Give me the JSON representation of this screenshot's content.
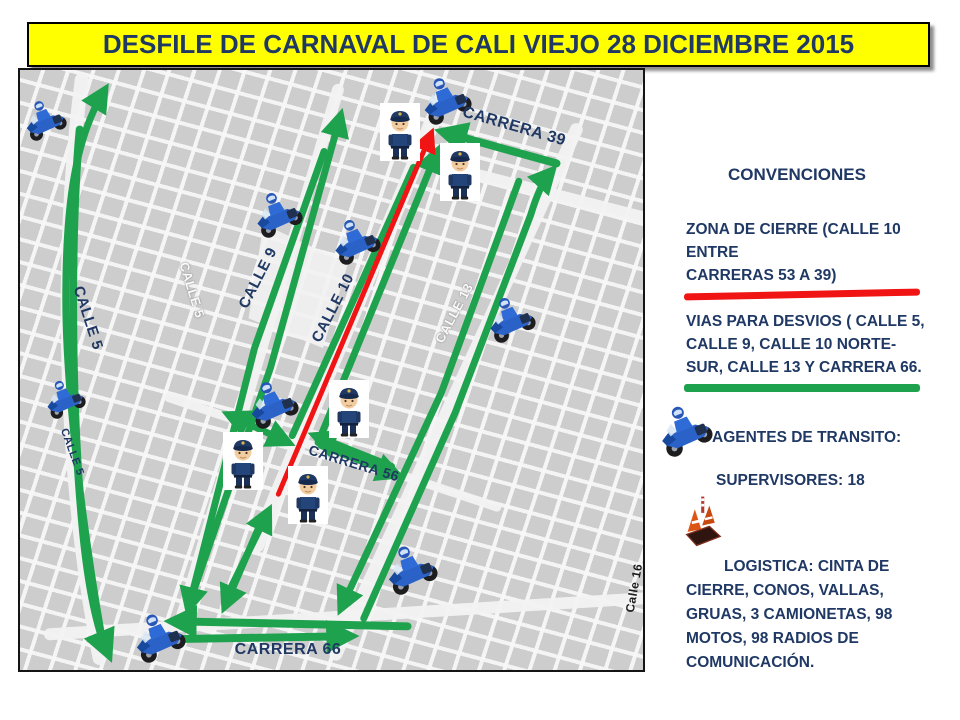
{
  "title": {
    "text": "DESFILE DE CARNAVAL DE CALI VIEJO 28 DICIEMBRE 2015"
  },
  "colors": {
    "navy": "#1F3864",
    "green": "#1FA24E",
    "red": "#F01414",
    "banner_yellow": "#FFFF00"
  },
  "map": {
    "street_labels": [
      {
        "text": "CALLE 5",
        "x": 68,
        "y": 248,
        "rot": 72,
        "style": "blue",
        "size": 15
      },
      {
        "text": "CALLE 5",
        "x": 172,
        "y": 220,
        "rot": 73,
        "style": "white",
        "size": 13
      },
      {
        "text": "CALLE 5",
        "x": 52,
        "y": 382,
        "rot": 70,
        "style": "blue",
        "size": 11
      },
      {
        "text": "CALLE 9",
        "x": 238,
        "y": 208,
        "rot": -63,
        "style": "blue",
        "size": 15
      },
      {
        "text": "CALLE 10",
        "x": 313,
        "y": 238,
        "rot": -63,
        "style": "blue",
        "size": 15
      },
      {
        "text": "CALLE 13",
        "x": 434,
        "y": 243,
        "rot": -62,
        "style": "white",
        "size": 13
      },
      {
        "text": "CARRERA 39",
        "x": 494,
        "y": 57,
        "rot": 16,
        "style": "blue",
        "size": 16
      },
      {
        "text": "CARRERA 56",
        "x": 334,
        "y": 393,
        "rot": 17,
        "style": "blue",
        "size": 14
      },
      {
        "text": "CARRERA 66",
        "x": 268,
        "y": 580,
        "rot": 0,
        "style": "blue",
        "size": 16
      },
      {
        "text": "Calle 16",
        "x": 614,
        "y": 518,
        "rot": -80,
        "style": "black",
        "size": 12
      }
    ],
    "routes": [
      {
        "name": "calle5-north",
        "color": "green",
        "width": 7,
        "arrows": "end",
        "d": "M 84,580 C 66,480 46,330 46,230 C 46,150 52,75 84,22"
      },
      {
        "name": "calle5-south",
        "color": "green",
        "width": 8,
        "arrows": "end",
        "d": "M 60,60 C 50,170 52,340 62,450 C 68,520 78,562 88,586"
      },
      {
        "name": "calle9-north",
        "color": "green",
        "width": 7,
        "arrows": "end",
        "d": "M 170,538 L 252,300 L 322,48"
      },
      {
        "name": "calle9-south",
        "color": "green",
        "width": 7,
        "arrows": "end",
        "d": "M 306,82 L 236,280 L 170,540"
      },
      {
        "name": "calle10-north",
        "color": "green",
        "width": 7,
        "arrows": "end",
        "d": "M 300,375 L 419,84"
      },
      {
        "name": "calle10-link",
        "color": "green",
        "width": 7,
        "arrows": "none",
        "d": "M 396,98 L 274,368"
      },
      {
        "name": "calle10-sur-north",
        "color": "green",
        "width": 7,
        "arrows": "end",
        "d": "M 206,534 L 249,446"
      },
      {
        "name": "calle10-sur-south",
        "color": "green",
        "width": 7,
        "arrows": "end",
        "d": "M 244,452 L 207,538"
      },
      {
        "name": "carrera39-westbound",
        "color": "green",
        "width": 8,
        "arrows": "end",
        "d": "M 540,94 L 428,63"
      },
      {
        "name": "calle13-north",
        "color": "green",
        "width": 7,
        "arrows": "end",
        "d": "M 346,552 L 438,345 L 514,146 C 520,126 526,112 534,103"
      },
      {
        "name": "calle13-south",
        "color": "green",
        "width": 7,
        "arrows": "end",
        "d": "M 502,112 L 424,325 L 324,540"
      },
      {
        "name": "carrera56-crossing",
        "color": "green",
        "width": 7,
        "arrows": "both",
        "d": "M 212,348 L 268,374"
      },
      {
        "name": "carrera56-westbound",
        "color": "green",
        "width": 7,
        "arrows": "end",
        "d": "M 374,399 L 299,369"
      },
      {
        "name": "carrera56-eastbound",
        "color": "green",
        "width": 7,
        "arrows": "end",
        "d": "M 303,378 L 378,407"
      },
      {
        "name": "carrera66-westbound",
        "color": "green",
        "width": 8,
        "arrows": "end",
        "d": "M 390,560 L 156,555"
      },
      {
        "name": "carrera66-eastbound",
        "color": "green",
        "width": 8,
        "arrows": "end",
        "d": "M 150,573 L 330,570"
      },
      {
        "name": "calle10-closure",
        "color": "red",
        "width": 5,
        "arrows": "end",
        "d": "M 260,427 L 413,66"
      }
    ],
    "moto_icons": [
      {
        "x": 24,
        "y": 48,
        "s": 46
      },
      {
        "x": 257,
        "y": 142,
        "s": 52
      },
      {
        "x": 425,
        "y": 28,
        "s": 54
      },
      {
        "x": 335,
        "y": 169,
        "s": 52
      },
      {
        "x": 490,
        "y": 247,
        "s": 52
      },
      {
        "x": 252,
        "y": 332,
        "s": 54
      },
      {
        "x": 390,
        "y": 497,
        "s": 56
      },
      {
        "x": 138,
        "y": 565,
        "s": 56
      },
      {
        "x": 44,
        "y": 327,
        "s": 44
      }
    ],
    "officer_icons": [
      {
        "x": 360,
        "y": 33
      },
      {
        "x": 420,
        "y": 73
      },
      {
        "x": 309,
        "y": 310
      },
      {
        "x": 203,
        "y": 362
      },
      {
        "x": 268,
        "y": 396
      }
    ]
  },
  "legend": {
    "heading": "CONVENCIONES",
    "closure_text": "ZONA DE CIERRE (CALLE 10\nENTRE\nCARRERAS  53 A 39)",
    "detour_text": "VIAS PARA DESVIOS ( CALLE 5,\nCALLE 9, CALLE 10 NORTE-\nSUR, CALLE 13 Y CARRERA 66.",
    "agents_label": "AGENTES DE TRANSITO:",
    "supervisors_label": "SUPERVISORES: 18",
    "logistics_text": "LOGISTICA: CINTA DE\nCIERRE, CONOS, VALLAS,\nGRUAS, 3 CAMIONETAS, 98\nMOTOS, 98 RADIOS DE\nCOMUNICACIÓN."
  }
}
